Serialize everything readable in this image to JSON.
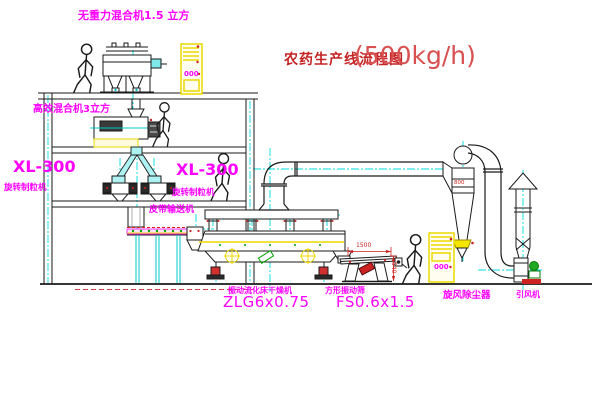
{
  "title": {
    "name_cn": "农药生产线流程图",
    "capacity": "(500kg/h)"
  },
  "labels": {
    "mixer_top": "无重力混合机1.5 立方",
    "mixer_mid": "高效混合机3立方",
    "granulator_left_model": "XL-300",
    "granulator_left_name": "旋转制粒机",
    "granulator_right_model": "XL-300",
    "granulator_right_name": "旋转制粒机",
    "belt_conveyor": "皮带输送机",
    "dryer_name": "振动流化床干燥机",
    "dryer_model": "ZLG6x0.75",
    "screen_name": "方形振动筛",
    "screen_model": "FS0.6x1.5",
    "cyclone_name": "旋风除尘器",
    "fan_name": "引风机"
  },
  "displays": {
    "cabinet_top": "000",
    "cabinet_bottom": "000"
  },
  "dimensions": {
    "screen_width": "1500",
    "screen_height": "540",
    "cyclone_dia": "800"
  },
  "colors": {
    "label_magenta": "#ff00ff",
    "title_red": "#c42424",
    "centerline_cyan": "#00dcdc",
    "equipment_yellow": "#ecd800",
    "alarm_red": "#cc2222",
    "motor_green": "#20a820"
  }
}
